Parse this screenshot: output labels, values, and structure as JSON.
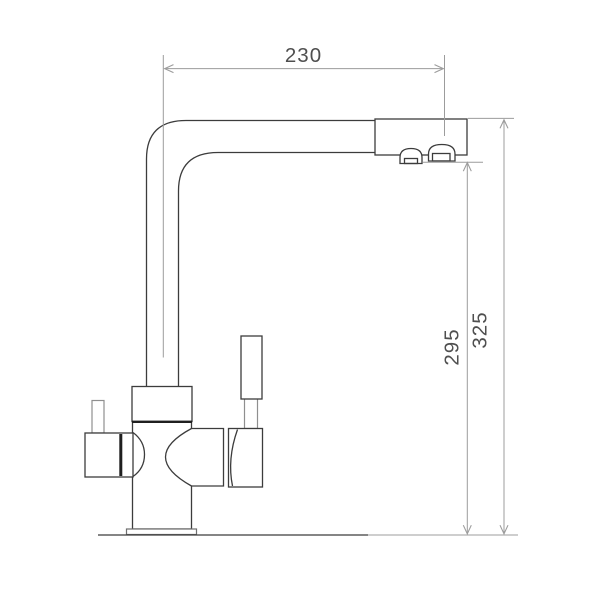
{
  "drawing": {
    "type": "technical-dimension-drawing",
    "subject": "kitchen-faucet-side-view",
    "dimensions": {
      "spout_reach": {
        "value": "230",
        "orientation": "horizontal",
        "position": "top"
      },
      "outlet_height": {
        "value": "295",
        "orientation": "vertical",
        "position": "right-inner"
      },
      "total_height": {
        "value": "325",
        "orientation": "vertical",
        "position": "right-outer"
      }
    }
  },
  "colors": {
    "background": "#ffffff",
    "line_dark": "#3c3c3c",
    "line_light": "#8f8f8f",
    "line_med": "#6f6f6f",
    "seam": "#1f1f1f",
    "dim_line": "#9c9c9c",
    "dim_text": "#4f4f4f"
  }
}
